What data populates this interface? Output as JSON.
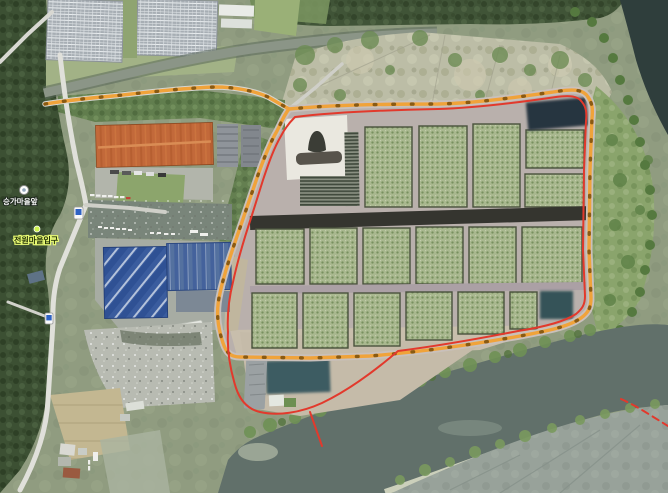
{
  "map": {
    "view": "satellite",
    "labels": {
      "bus_stop": "승가마을앞",
      "village_entrance": "전원마을입구"
    },
    "overlay": {
      "route_color": "#f0a33a",
      "route_tick_color": "#8a5a12",
      "boundary_color": "#e2392c"
    },
    "terrain_colors": {
      "river": "#61706a",
      "river_upper": "#2f3e3c",
      "orchard_plot": "#a9b88f",
      "warehouse_roof_blue": "#3a5c9e",
      "factory_roof_orange": "#c2693a"
    },
    "markers": {
      "bus_stop_icon": "white-circle",
      "village_marker": "green-dot",
      "road_sign_icon": "blue-on-white-badge"
    }
  }
}
